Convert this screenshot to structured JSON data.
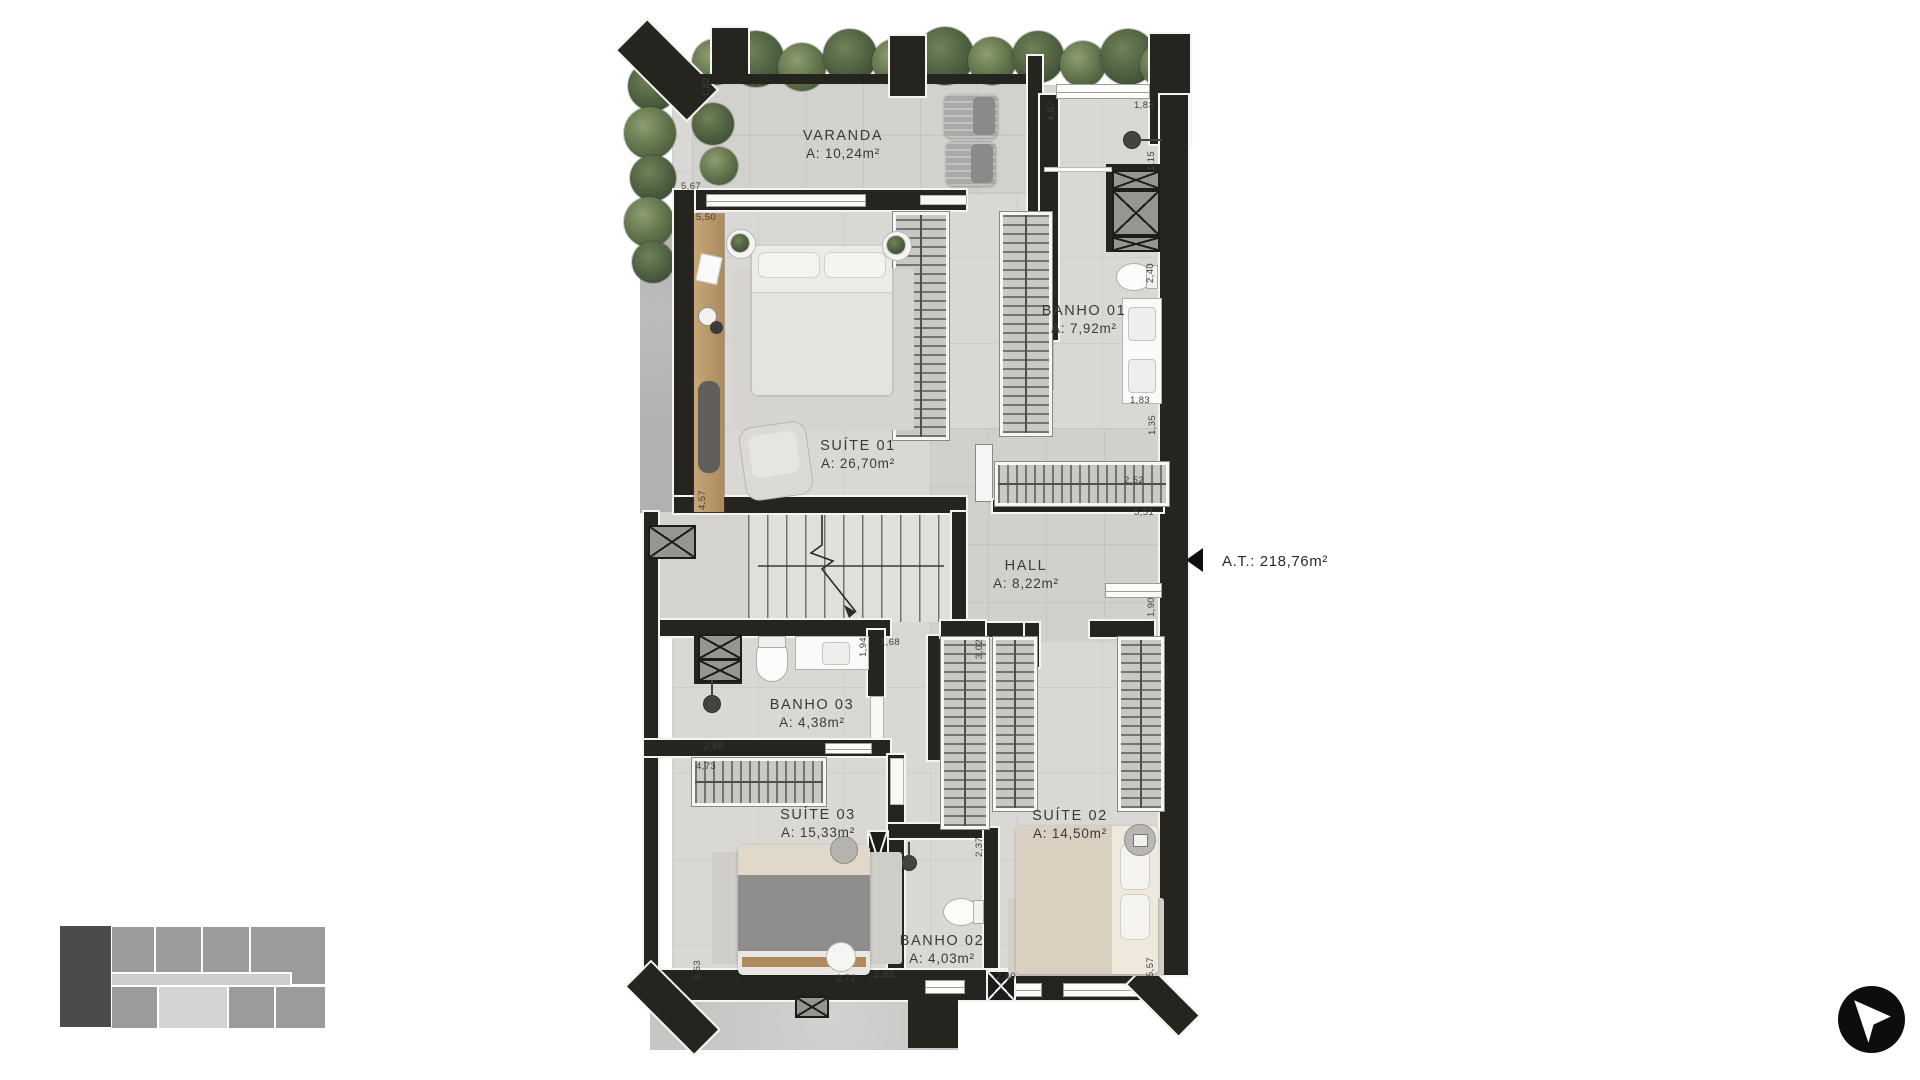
{
  "plan": {
    "rooms": [
      {
        "id": "varanda",
        "name": "VARANDA",
        "area": "A: 10,24m²"
      },
      {
        "id": "suite01",
        "name": "SUÍTE 01",
        "area": "A: 26,70m²"
      },
      {
        "id": "banho01",
        "name": "BANHO 01",
        "area": "A: 7,92m²"
      },
      {
        "id": "hall",
        "name": "HALL",
        "area": "A: 8,22m²"
      },
      {
        "id": "banho03",
        "name": "BANHO 03",
        "area": "A: 4,38m²"
      },
      {
        "id": "suite03",
        "name": "SUÍTE 03",
        "area": "A: 15,33m²"
      },
      {
        "id": "suite02",
        "name": "SUÍTE 02",
        "area": "A: 14,50m²"
      },
      {
        "id": "banho02",
        "name": "BANHO 02",
        "area": "A: 4,03m²"
      }
    ],
    "total_area_label": "A.T.: 218,76m²",
    "dimensions": [
      "1,82",
      "5,67",
      "5,50",
      "4,87",
      "1,83",
      "1,15",
      "2,40",
      "1,83",
      "1,35",
      "4,57",
      "2,52",
      "5,51",
      "1,90",
      "1,94",
      "1,68",
      "3,02",
      "2,88",
      "4,73",
      "2,37",
      "3,63",
      "2,72",
      "1,82",
      "2,60",
      "5,57"
    ]
  },
  "icons": {
    "north_arrow": "cursor-arrow-northwest-in-black-circle",
    "total_area_marker": "left-pointing-triangle"
  },
  "colors": {
    "wall": "#26241f",
    "floor": "#dad8d4",
    "plant_green": "#66784f",
    "label_text": "#3b3a37",
    "minimap_highlight": "#4b4b4b",
    "minimap_unit": "#9b9b9b"
  }
}
